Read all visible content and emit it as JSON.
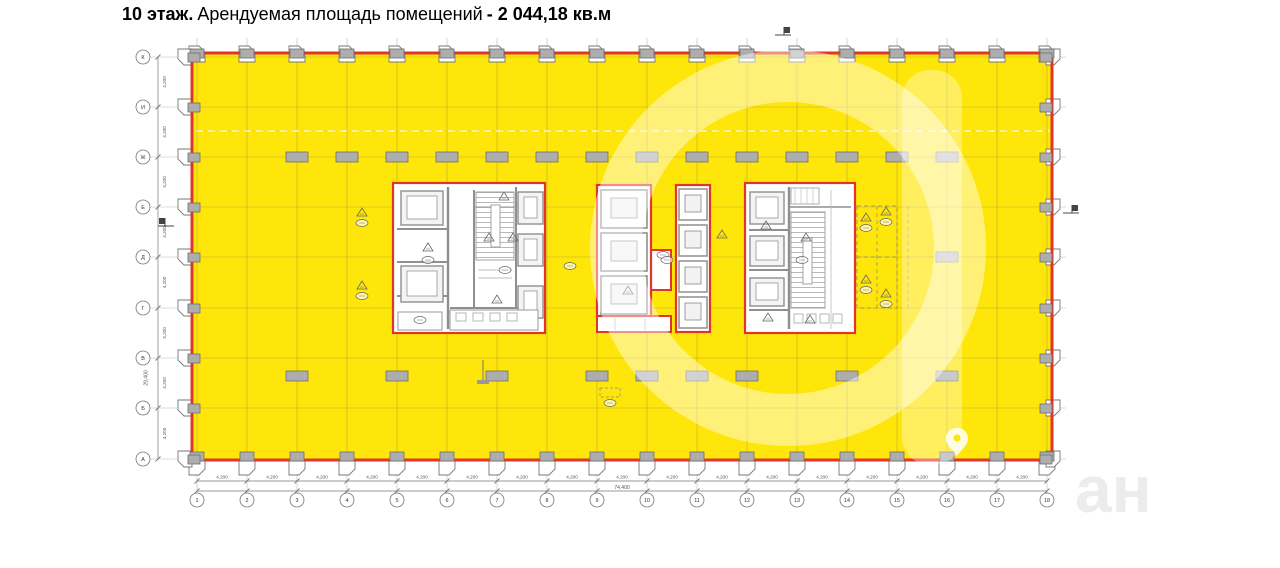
{
  "title": {
    "floor": "10 этаж.",
    "label": "Арендуемая площадь помещений",
    "area": "- 2 044,18 кв.м"
  },
  "plan": {
    "column_bubbles": [
      "1",
      "2",
      "3",
      "4",
      "5",
      "6",
      "7",
      "8",
      "9",
      "10",
      "11",
      "12",
      "13",
      "14",
      "15",
      "16",
      "17",
      "18"
    ],
    "row_bubbles": [
      "К",
      "И",
      "Ж",
      "Е",
      "Д",
      "Г",
      "В",
      "Б",
      "А"
    ],
    "bay_dim": "4,200",
    "total_width_dim": "74,400",
    "total_height_dim": "29,400",
    "colors": {
      "rentable_fill": "#FFE60A",
      "boundary_red": "#E0352B",
      "column_gray": "#ADADAD",
      "wall_gray": "#8F8F8F"
    }
  },
  "watermark": {
    "text_fragment": "ан",
    "icon": "location-pin-icon"
  }
}
